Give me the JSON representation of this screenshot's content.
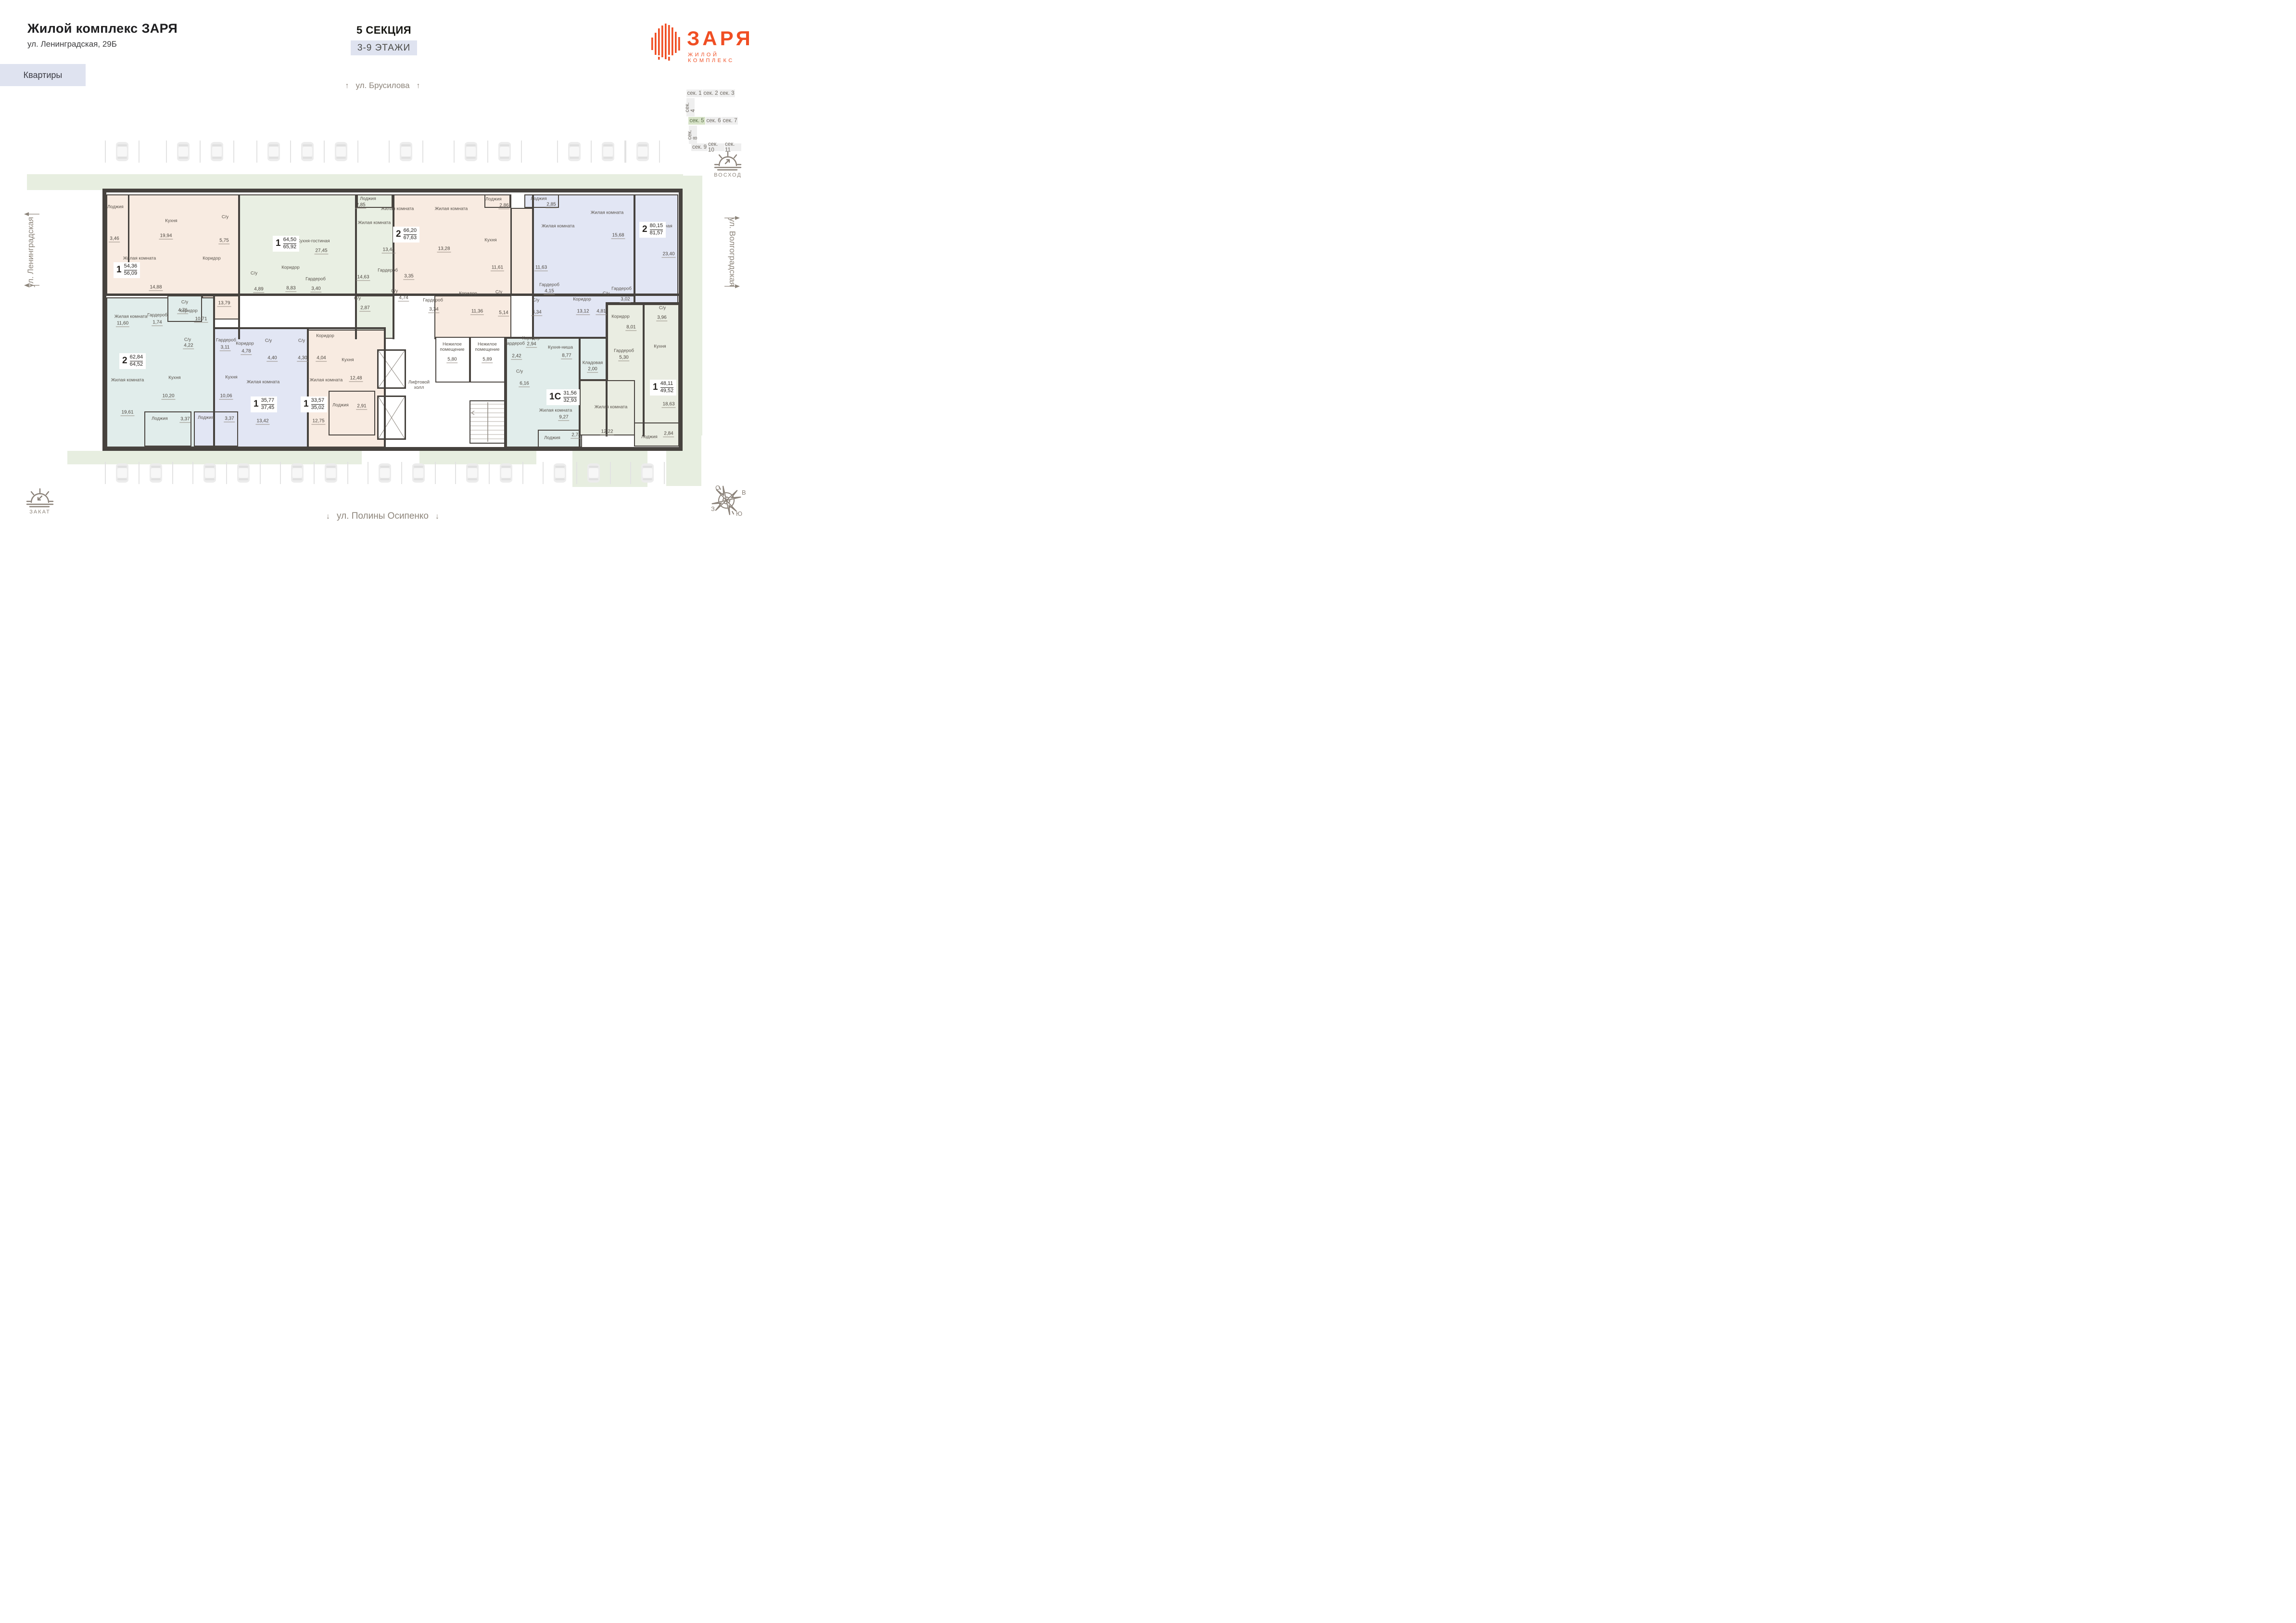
{
  "header": {
    "title": "Жилой комплекс ЗАРЯ",
    "address": "ул. Ленинградская, 29Б",
    "apartments_button": "Квартиры"
  },
  "section_info": {
    "title": "5 СЕКЦИЯ",
    "floors": "3-9 ЭТАЖИ"
  },
  "logo": {
    "name": "ЗАРЯ",
    "tagline": "ЖИЛОЙ КОМПЛЕКС"
  },
  "streets": {
    "top": "ул. Брусилова",
    "left": "ул. Ленинградская",
    "right": "ул. Волгоградская",
    "bottom": "ул. Полины Осипенко"
  },
  "orientation": {
    "sunrise": "ВОСХОД",
    "sunset": "ЗАКАТ",
    "compass": {
      "north": "С",
      "east": "В",
      "west": "З",
      "south": "Ю"
    }
  },
  "sections_nav": {
    "items": [
      {
        "label": "сек. 1"
      },
      {
        "label": "сек. 2"
      },
      {
        "label": "сек. 3"
      },
      {
        "label": "сек. 4",
        "vertical": true
      },
      {
        "label": "сек. 5",
        "active": true
      },
      {
        "label": "сек. 6"
      },
      {
        "label": "сек. 7"
      },
      {
        "label": "сек. 8",
        "vertical": true
      },
      {
        "label": "сек. 9"
      },
      {
        "label": "сек. 10"
      },
      {
        "label": "сек. 11"
      }
    ]
  },
  "apartments": [
    {
      "id": "apt-1",
      "rooms_count": "1",
      "area_living": "54,36",
      "area_total": "56,09",
      "color": "peach",
      "rooms": [
        {
          "name": "Лоджия",
          "area": "3,46"
        },
        {
          "name": "Кухня",
          "area": "19,94"
        },
        {
          "name": "С/у",
          "area": "5,75"
        },
        {
          "name": "Жилая комната",
          "area": "14,88"
        },
        {
          "name": "Коридор",
          "area": "13,79"
        },
        {
          "name": "С/у",
          "area": "4,76"
        },
        {
          "name": "Гардероб",
          "area": "1,74"
        }
      ]
    },
    {
      "id": "apt-2",
      "rooms_count": "1",
      "area_living": "64,50",
      "area_total": "65,92",
      "color": "green",
      "rooms": [
        {
          "name": "Кухня-гостиная",
          "area": "27,45"
        },
        {
          "name": "С/у",
          "area": "4,89"
        },
        {
          "name": "Коридор",
          "area": "8,83"
        },
        {
          "name": "Гардероб",
          "area": "3,40"
        },
        {
          "name": "Жилая комната",
          "area": "14,63"
        },
        {
          "name": "Лоджия",
          "area": "2,85"
        },
        {
          "name": "С/у",
          "area": "2,87"
        }
      ]
    },
    {
      "id": "apt-3",
      "rooms_count": "2",
      "area_living": "66,20",
      "area_total": "67,63",
      "color": "peach",
      "rooms": [
        {
          "name": "Жилая комната",
          "area": "13,44"
        },
        {
          "name": "Жилая комната",
          "area": "13,28"
        },
        {
          "name": "Кухня",
          "area": "11,61"
        },
        {
          "name": "Гардероб",
          "area": "3,35"
        },
        {
          "name": "С/у",
          "area": "4,74"
        },
        {
          "name": "Гардероб",
          "area": "3,34"
        },
        {
          "name": "Коридор",
          "area": "11,36"
        },
        {
          "name": "С/у",
          "area": "5,14"
        },
        {
          "name": "Лоджия",
          "area": "2,86"
        }
      ]
    },
    {
      "id": "apt-4",
      "rooms_count": "2",
      "area_living": "80,15",
      "area_total": "81,57",
      "color": "lavender",
      "rooms": [
        {
          "name": "Лоджия",
          "area": "2,85"
        },
        {
          "name": "Жилая комната",
          "area": "11,63"
        },
        {
          "name": "Жилая комната",
          "area": "15,68"
        },
        {
          "name": "Кухня-гостиная",
          "area": "23,40"
        },
        {
          "name": "С/у",
          "area": "4,34"
        },
        {
          "name": "Гардероб",
          "area": "4,15"
        },
        {
          "name": "Коридор",
          "area": "13,12"
        },
        {
          "name": "С/у",
          "area": "4,81"
        },
        {
          "name": "Гардероб",
          "area": "3,02"
        }
      ]
    },
    {
      "id": "apt-5",
      "rooms_count": "2",
      "area_living": "62,84",
      "area_total": "64,52",
      "color": "teal",
      "rooms": [
        {
          "name": "Жилая комната",
          "area": "11,60"
        },
        {
          "name": "Жилая комната",
          "area": "19,61"
        },
        {
          "name": "Кухня",
          "area": "10,20"
        },
        {
          "name": "Коридор",
          "area": "10,71"
        },
        {
          "name": "С/у",
          "area": "4,22"
        },
        {
          "name": "Лоджия",
          "area": "3,37"
        }
      ]
    },
    {
      "id": "apt-6",
      "rooms_count": "1",
      "area_living": "35,77",
      "area_total": "37,45",
      "color": "lavender",
      "rooms": [
        {
          "name": "Коридор",
          "area": "4,78"
        },
        {
          "name": "С/у",
          "area": "4,40"
        },
        {
          "name": "Жилая комната",
          "area": "13,42"
        },
        {
          "name": "Гардероб",
          "area": "3,11"
        },
        {
          "name": "Кухня",
          "area": "10,06"
        },
        {
          "name": "Лоджия",
          "area": "3,37"
        }
      ]
    },
    {
      "id": "apt-7",
      "rooms_count": "1",
      "area_living": "33,57",
      "area_total": "35,02",
      "color": "peach",
      "rooms": [
        {
          "name": "С/у",
          "area": "4,30"
        },
        {
          "name": "Коридор",
          "area": "4,04"
        },
        {
          "name": "Жилая комната",
          "area": "12,75"
        },
        {
          "name": "Кухня",
          "area": "12,48"
        },
        {
          "name": "Лоджия",
          "area": "2,91"
        }
      ]
    },
    {
      "id": "apt-8",
      "rooms_count": "1С",
      "area_living": "31,56",
      "area_total": "32,93",
      "color": "teal",
      "rooms": [
        {
          "name": "Гардероб",
          "area": "2,42"
        },
        {
          "name": "Коридор",
          "area": "2,94"
        },
        {
          "name": "С/у",
          "area": "6,16"
        },
        {
          "name": "Кухня-ниша",
          "area": "8,77"
        },
        {
          "name": "Кладовая",
          "area": "2,00"
        },
        {
          "name": "Жилая комната",
          "area": "9,27"
        },
        {
          "name": "Лоджия",
          "area": "2,74"
        }
      ]
    },
    {
      "id": "apt-9",
      "rooms_count": "1",
      "area_living": "48,11",
      "area_total": "49,52",
      "color": "sage",
      "rooms": [
        {
          "name": "Коридор",
          "area": "8,01"
        },
        {
          "name": "С/у",
          "area": "3,96"
        },
        {
          "name": "Гардероб",
          "area": "5,30"
        },
        {
          "name": "Кухня",
          "area": "18,63"
        },
        {
          "name": "Жилая комната",
          "area": "12,22"
        },
        {
          "name": "Лоджия",
          "area": "2,84"
        }
      ]
    }
  ],
  "common_areas": [
    {
      "name": "Лифтовой холл",
      "area": ""
    },
    {
      "name": "Нежилое помещение",
      "area": "5,80"
    },
    {
      "name": "Нежилое помещение",
      "area": "5,89"
    }
  ],
  "colors": {
    "accent": "#f04e23",
    "peach": "#f8ebe1",
    "green": "#e9efe3",
    "lavender": "#e2e6f4",
    "teal": "#e1edeb",
    "sage": "#eaede2",
    "greenery": "#e7eee0",
    "nav_active": "#d7e3c8",
    "wall": "#46423e"
  }
}
